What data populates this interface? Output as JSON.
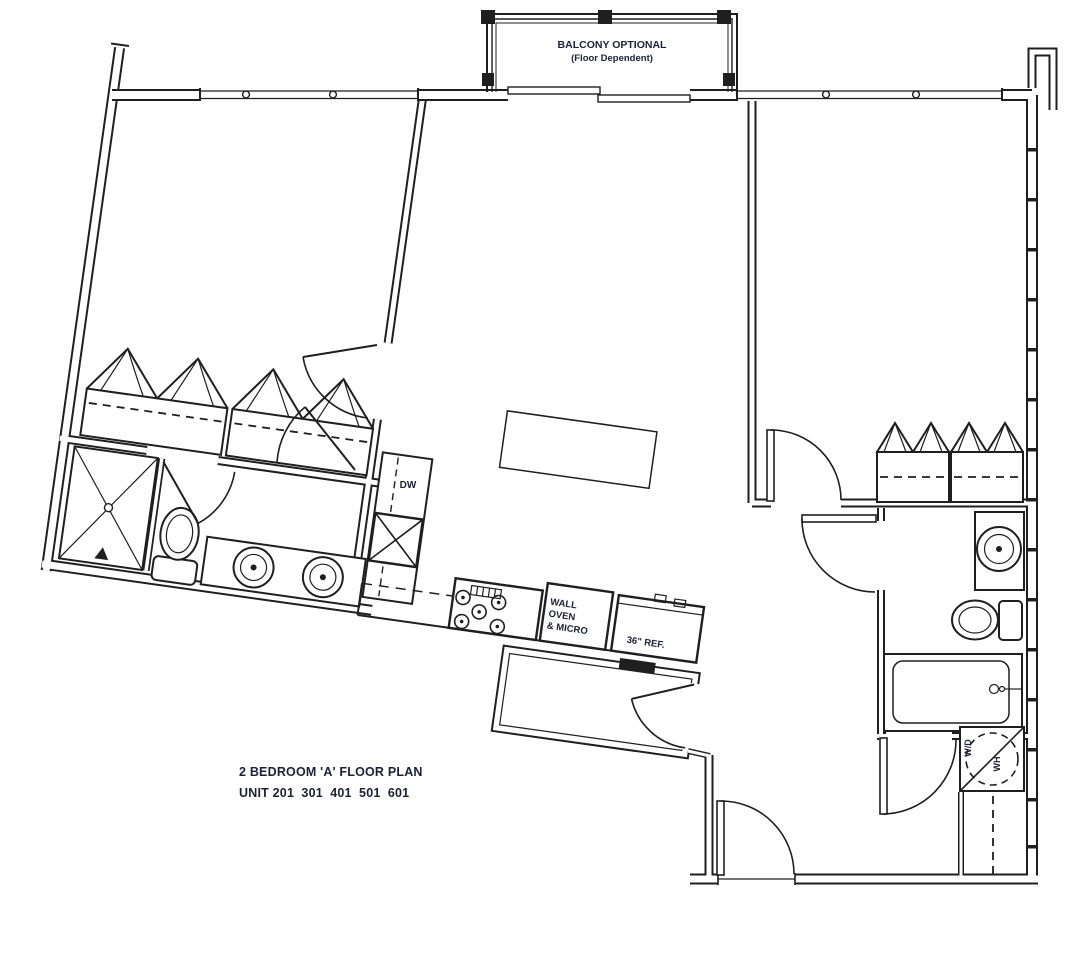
{
  "colors": {
    "ink": "#1f1f1f",
    "label": "#1b2236",
    "background": "#ffffff"
  },
  "balcony": {
    "line1": "BALCONY OPTIONAL",
    "line2": "(Floor Dependent)"
  },
  "kitchen": {
    "dishwasher": "DW",
    "oven_line1": "WALL",
    "oven_line2": "OVEN",
    "oven_line3": "& MICRO",
    "fridge": "36\" REF."
  },
  "laundry": {
    "washer_dryer": "W/D",
    "water_heater": "WH"
  },
  "title": {
    "line1": "2 BEDROOM 'A' FLOOR PLAN",
    "line2": "UNIT 201  301  401  501  601"
  }
}
